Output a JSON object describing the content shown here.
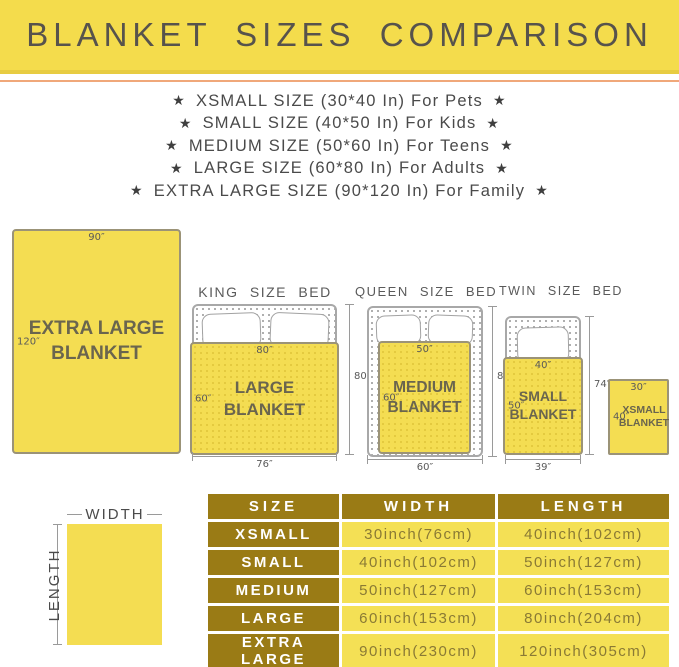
{
  "colors": {
    "banner_bg": "#f4dc4c",
    "banner_border": "#e7cc42",
    "orange_line": "#f0a87a",
    "title_color": "#57534c",
    "list_color": "#4a4a4a",
    "yellow": "#f4dd52",
    "yellow_dot": "#e3c93e",
    "blanket_border": "#9b9377",
    "blanket_text": "#6a654e",
    "bed_border": "#a8a8a8",
    "bed_dot": "#a0a0a0",
    "dim_color": "#5a5a5a",
    "dim_line": "#9a9a9a",
    "table_dark": "#9a7b15",
    "table_yellow": "#f4e055",
    "table_data_text": "#8a7a35"
  },
  "banner": {
    "title": "BLANKET SIZES COMPARISON"
  },
  "size_list": {
    "star_icon": "★",
    "items": [
      "XSMALL SIZE (30*40 In) For Pets",
      "SMALL SIZE (40*50 In) For Kids",
      "MEDIUM SIZE (50*60 In) For Teens",
      "LARGE SIZE (60*80 In) For Adults",
      "EXTRA LARGE SIZE (90*120 In) For Family"
    ]
  },
  "diagram": {
    "xl_blanket": {
      "line1": "EXTRA LARGE",
      "line2": "BLANKET",
      "top_dim": "90″",
      "side_dim": "120″"
    },
    "beds": [
      {
        "title": "KING SIZE BED",
        "blanket": {
          "line1": "LARGE BLANKET",
          "top_dim": "80″",
          "side_dim": "60″"
        },
        "width_dim": "76″",
        "height_dim": "80″"
      },
      {
        "title": "QUEEN SIZE BED",
        "blanket": {
          "line1": "MEDIUM",
          "line2": "BLANKET",
          "top_dim": "50″",
          "side_dim": "60″"
        },
        "width_dim": "60″",
        "height_dim": "80″"
      },
      {
        "title": "TWIN SIZE BED",
        "blanket": {
          "line1": "SMALL",
          "line2": "BLANKET",
          "top_dim": "40″",
          "side_dim": "50″"
        },
        "width_dim": "39″",
        "height_dim": "74″"
      }
    ],
    "xsmall_blanket": {
      "line1": "XSMALL",
      "line2": "BLANKET",
      "top_dim": "30″",
      "side_dim": "40″"
    }
  },
  "legend": {
    "width": "WIDTH",
    "length": "LENGTH"
  },
  "table": {
    "columns": [
      "SIZE",
      "WIDTH",
      "LENGTH"
    ],
    "rows": [
      [
        "XSMALL",
        "30inch(76cm)",
        "40inch(102cm)"
      ],
      [
        "SMALL",
        "40inch(102cm)",
        "50inch(127cm)"
      ],
      [
        "MEDIUM",
        "50inch(127cm)",
        "60inch(153cm)"
      ],
      [
        "LARGE",
        "60inch(153cm)",
        "80inch(204cm)"
      ],
      [
        "EXTRA LARGE",
        "90inch(230cm)",
        "120inch(305cm)"
      ]
    ]
  }
}
